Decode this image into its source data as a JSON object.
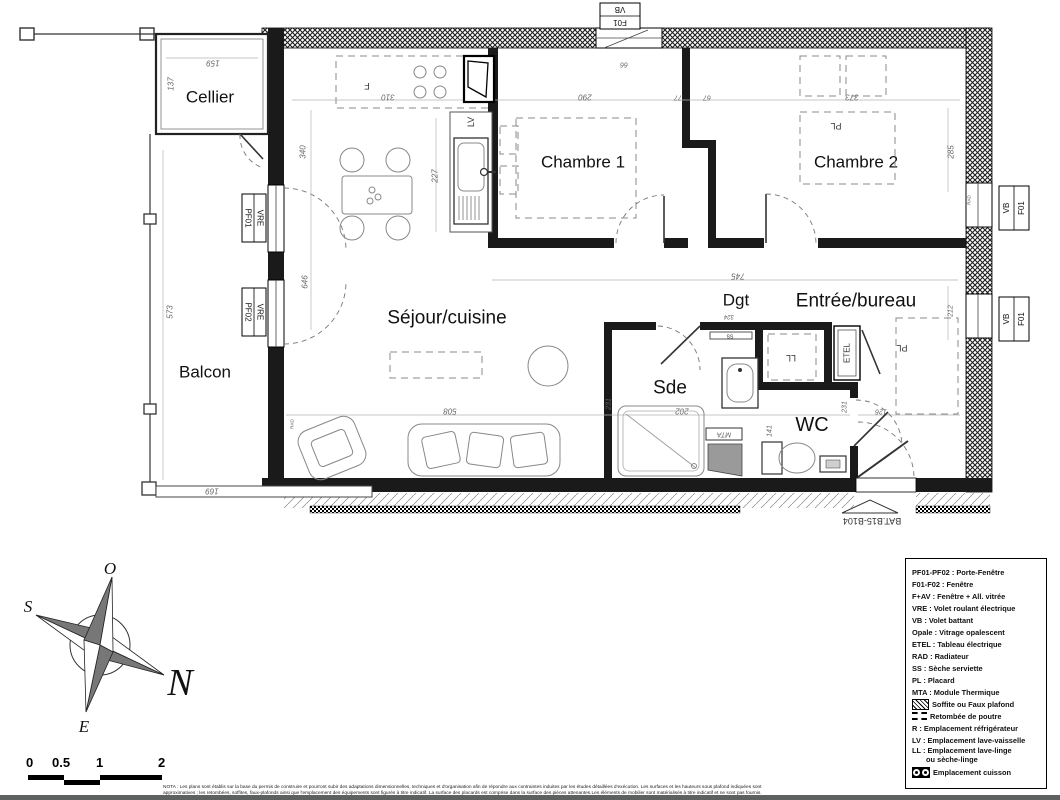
{
  "plan": {
    "rooms": {
      "cellier": "Cellier",
      "balcon": "Balcon",
      "sejour": "Séjour/cuisine",
      "chambre1": "Chambre 1",
      "chambre2": "Chambre 2",
      "dgt": "Dgt",
      "entree": "Entrée/bureau",
      "sde": "Sde",
      "wc": "WC"
    },
    "openings": {
      "top_window_code": "F01",
      "top_window_shutter": "VB",
      "right_window1_code": "F01",
      "right_window1_shutter": "VB",
      "right_window2_code": "F01",
      "right_window2_shutter": "VB",
      "left_door1_code": "PF01",
      "left_door1_shutter": "VRE",
      "left_door2_code": "PF02",
      "left_door2_shutter": "VRE"
    },
    "equipment": {
      "kitchen_window": "F",
      "dishwasher": "LV",
      "closet_chambre2": "PL",
      "closet_entree": "PL",
      "towel_dryer": "SS",
      "washer": "LL",
      "electrical_panel": "ETEL",
      "thermal_module": "MTA",
      "radiator_right": "RAD",
      "radiator_left": "RAD"
    },
    "dims": {
      "d159": "159",
      "d137": "137",
      "d310": "310",
      "d227": "227",
      "d290": "290",
      "d77": "77",
      "d67": "67",
      "d66": "66",
      "d373": "373",
      "d285": "285",
      "d340": "340",
      "d646": "646",
      "d573": "573",
      "d169": "169",
      "d745": "745",
      "d508": "508",
      "d202": "202",
      "d231a": "231",
      "d231b": "231",
      "d141": "141",
      "d126": "126",
      "d212": "212",
      "d324": "324"
    },
    "building_ref": "BAT.B15-B104"
  },
  "legend": {
    "items": [
      {
        "text": "PF01-PF02 : Porte-Fenêtre"
      },
      {
        "text": "F01-F02 : Fenêtre"
      },
      {
        "text": "F+AV : Fenêtre + All. vitrée"
      },
      {
        "text": "VRE : Volet roulant électrique"
      },
      {
        "text": "VB : Volet battant"
      },
      {
        "text": "Opale : Vitrage opalescent"
      },
      {
        "text": "ETEL : Tableau électrique"
      },
      {
        "text": "RAD : Radiateur"
      },
      {
        "text": "SS : Sèche serviette"
      },
      {
        "text": "PL : Placard"
      },
      {
        "text": "MTA : Module Thermique"
      },
      {
        "icon": "soffite-icon",
        "text": "Soffite ou Faux plafond"
      },
      {
        "icon": "beam-icon",
        "text": "Retombée de poutre"
      },
      {
        "text": "R : Emplacement réfrigérateur"
      },
      {
        "text": "LV : Emplacement lave-vaisselle"
      },
      {
        "text": "LL : Emplacement lave-linge",
        "text2": "ou sèche-linge"
      },
      {
        "icon": "cooktop-icon",
        "text": "Emplacement cuisson"
      }
    ]
  },
  "compass": {
    "north": "N",
    "south": "S",
    "east": "E",
    "west": "O"
  },
  "scale_bar": {
    "labels": [
      "0",
      "0.5",
      "1",
      "2"
    ]
  },
  "nota": {
    "line1": "NOTA : Les plans sont établis sur la base du permis de construire et pourront subir des adaptations dimensionnelles, techniques et d'organisation afin de répondre aux contraintes induites par les études détaillées d'exécution. Les surfaces et les hauteurs sous plafond indiquées sont",
    "line2": "approximatives ; les retombées, soffites, faux-plafonds ainsi que l'emplacement des équipements sont figurés à titre indicatif. La surface des placards est comprise dans la surface des pièces attenantes.Les éléments de mobilier sont matérialisés à titre indicatif et ne sont pas fournis."
  }
}
